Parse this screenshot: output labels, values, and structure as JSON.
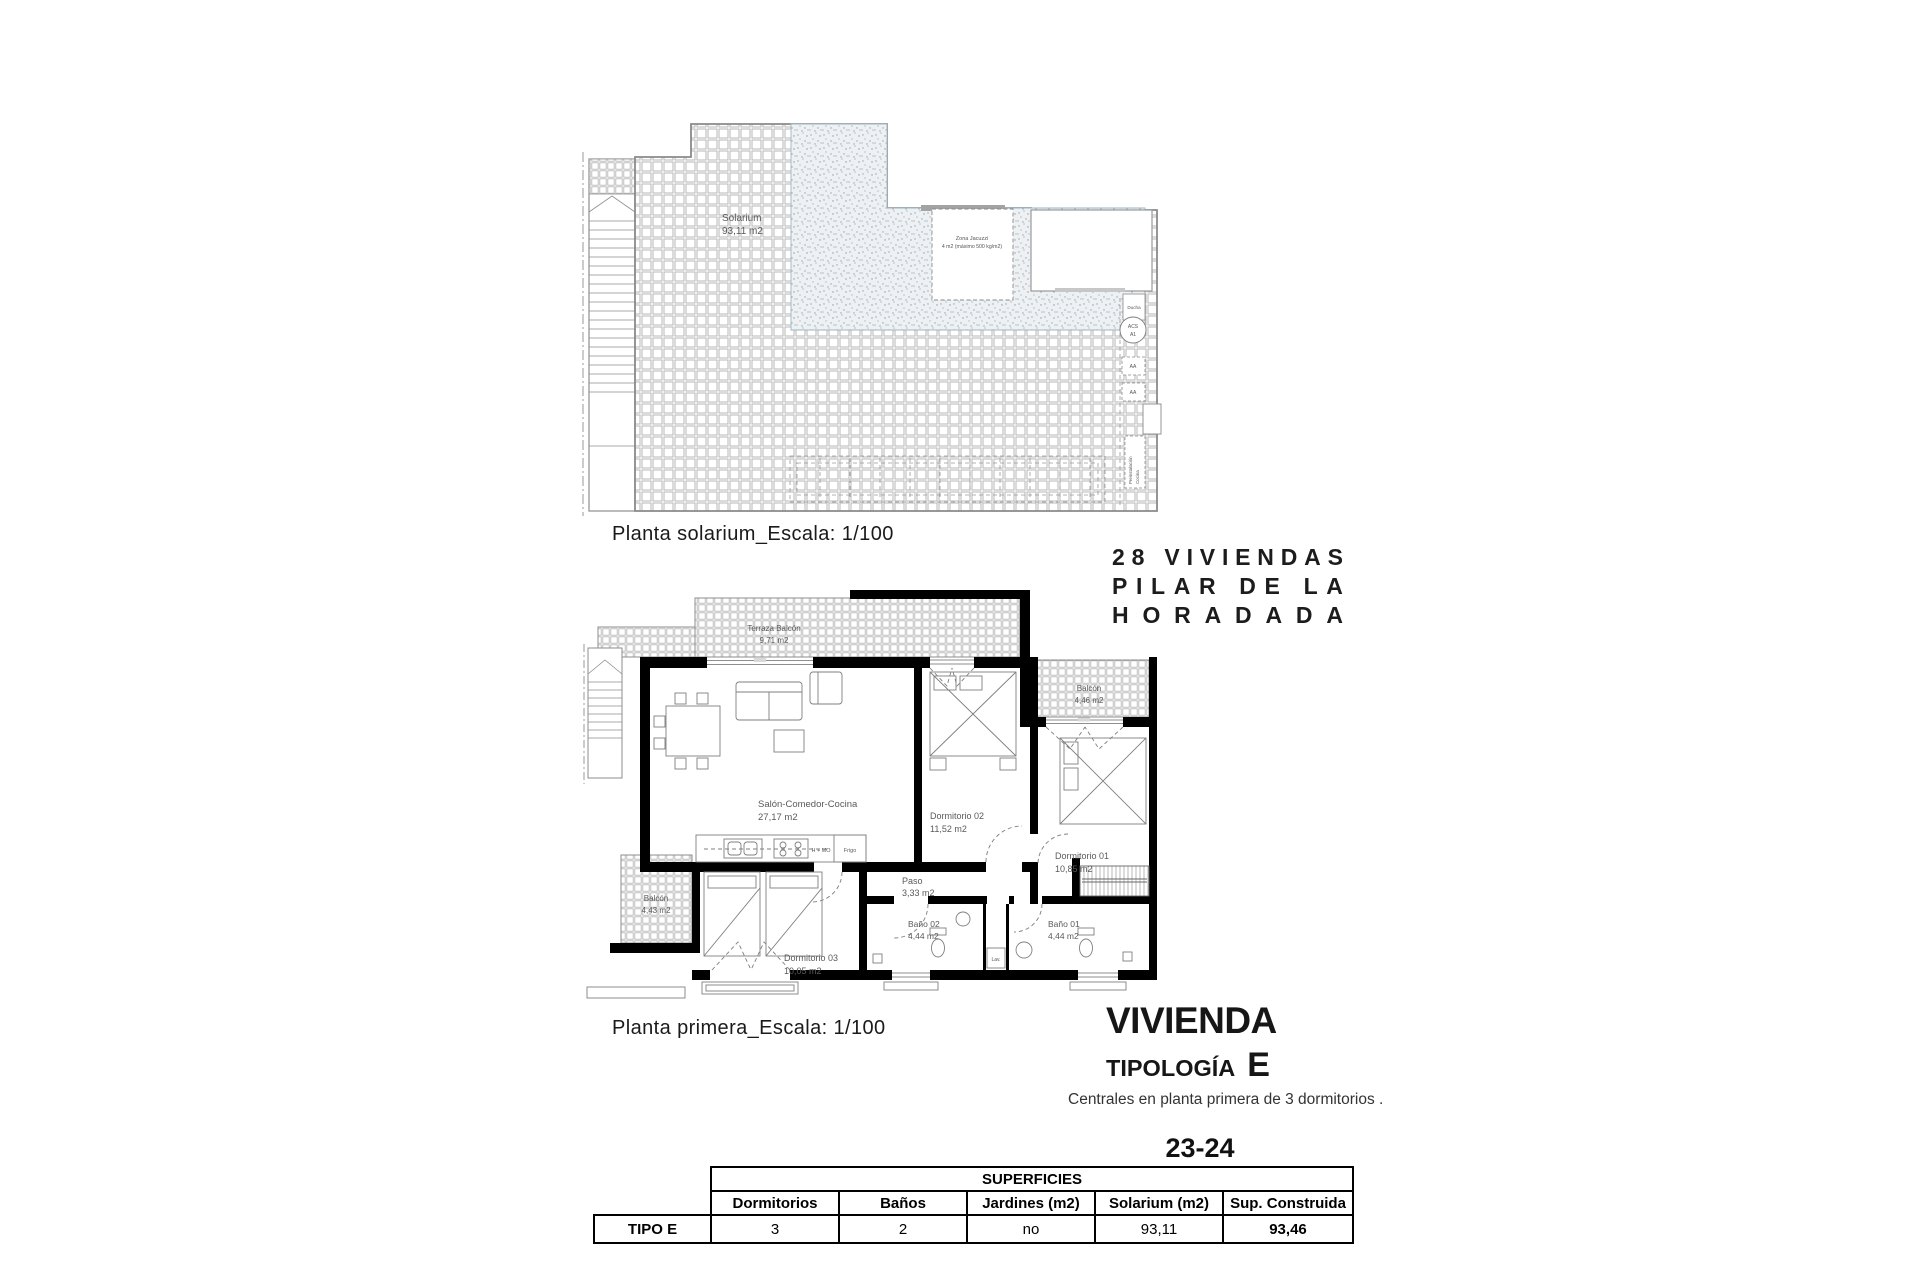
{
  "solarium_plan": {
    "caption": "Planta solarium_Escala: 1/100",
    "solarium_label": {
      "name": "Solarium",
      "area": "93,11 m2"
    },
    "jacuzzi_label": {
      "line1": "Zona Jacuzzi",
      "line2": "4 m2 (máximo 500 kg/m2)"
    },
    "ducha_label": "Ducha",
    "acs_label": "ACS",
    "a1_label": "A1",
    "aa_label": "AA",
    "preinstalacion_label": {
      "line1": "Preinstalación",
      "line2": "Cocina"
    }
  },
  "first_floor_plan": {
    "caption": "Planta primera_Escala: 1/100",
    "rooms": {
      "salon": {
        "name": "Salón-Comedor-Cocina",
        "area": "27,17 m2"
      },
      "dormitorio02": {
        "name": "Dormitorio 02",
        "area": "11,52 m2"
      },
      "dormitorio01": {
        "name": "Dormitorio 01",
        "area": "10,85 m2"
      },
      "dormitorio03": {
        "name": "Dormitorio 03",
        "area": "10,05 m2"
      },
      "paso": {
        "name": "Paso",
        "area": "3,33 m2"
      },
      "bano02": {
        "name": "Baño 02",
        "area": "4,44 m2"
      },
      "bano01": {
        "name": "Baño 01",
        "area": "4,44 m2"
      },
      "balcon_oeste": {
        "name": "Balcón",
        "area": "4,43 m2"
      },
      "balcon_este": {
        "name": "Balcón",
        "area": "4,46 m2"
      },
      "terraza": {
        "name": "Terraza Balcón",
        "area": "9,71 m2"
      }
    },
    "equipment": {
      "horno_micro": "H + MO",
      "frigo": "Frigo",
      "lavadora": "Lav."
    }
  },
  "project": {
    "title_lines": [
      "28 VIVIENDAS",
      "PILAR DE LA",
      "HORADADA"
    ]
  },
  "typology": {
    "heading": "VIVIENDA",
    "subheading": "TIPOLOGÍA",
    "letter": "E",
    "description": "Centrales en planta primera de 3 dormitorios .",
    "units": "23-24"
  },
  "surfaces_table": {
    "title": "SUPERFICIES",
    "row_label": "TIPO E",
    "columns": [
      "Dormitorios",
      "Baños",
      "Jardines (m2)",
      "Solarium (m2)",
      "Sup. Construida"
    ],
    "values": [
      "3",
      "2",
      "no",
      "93,11",
      "93,46"
    ]
  },
  "colors": {
    "wall": "#000000",
    "line": "#8a8a8a",
    "label": "#5a5a5a",
    "stipple": "#edf0f3"
  }
}
